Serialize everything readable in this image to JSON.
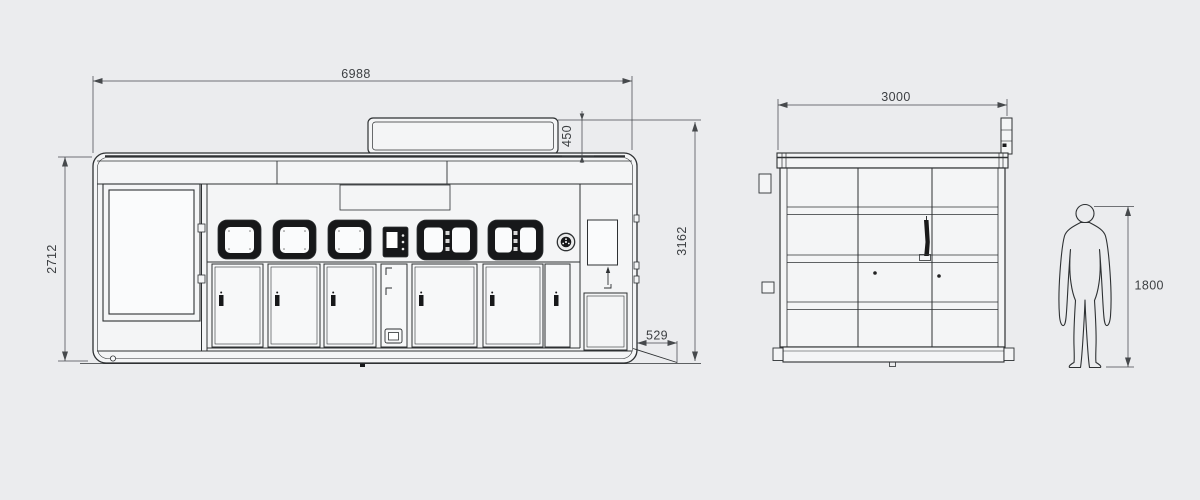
{
  "title": "machine-dimension-drawing",
  "colors": {
    "background": "#ebecee",
    "line": "#2e3133",
    "dim_line": "#46494c",
    "dim_text": "#3c3f42",
    "frame_black": "#17181a",
    "panel_fill": "#f4f5f6",
    "pane_fill": "#fafbfc"
  },
  "front_view": {
    "overall_width": "6988",
    "body_height": "2712",
    "sign_height": "450",
    "overall_height": "3162",
    "ramp_depth": "529"
  },
  "side_view": {
    "overall_depth": "3000"
  },
  "human_figure": {
    "height": "1800"
  }
}
